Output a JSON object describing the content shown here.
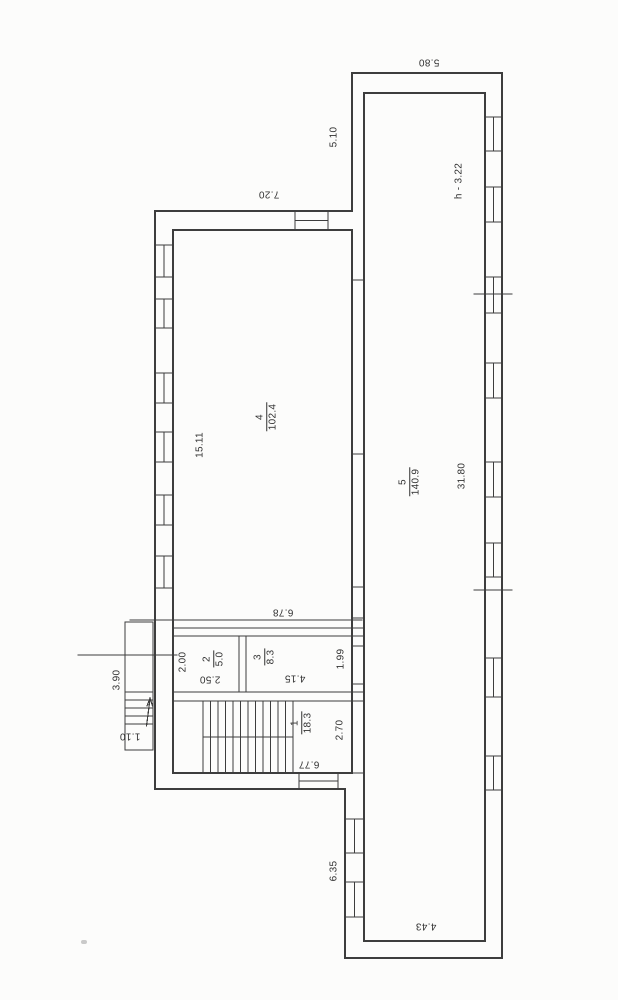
{
  "plan": {
    "rooms": {
      "room1": {
        "number": "1",
        "area": "18.3"
      },
      "room2": {
        "number": "2",
        "area": "5.0"
      },
      "room3": {
        "number": "3",
        "area": "8.3"
      },
      "room4": {
        "number": "4",
        "area": "102.4"
      },
      "room5": {
        "number": "5",
        "area": "140.9"
      }
    },
    "dimensions": {
      "corridor_top_width": "5.80",
      "annex_top_height": "5.10",
      "height_note": "h - 3.22",
      "main_top_width": "7.20",
      "room4_length": "15.11",
      "room4_width": "6.78",
      "corridor_length": "31.80",
      "corridor_width": "4.43",
      "room2_depth": "2.00",
      "room2_width": "2.50",
      "room3_width": "4.15",
      "room3_depth": "1.99",
      "porch_length": "3.90",
      "steps_width": "1.10",
      "room1_depth": "2.70",
      "room1_width": "6.77",
      "wing_left_segment": "6.35"
    }
  }
}
